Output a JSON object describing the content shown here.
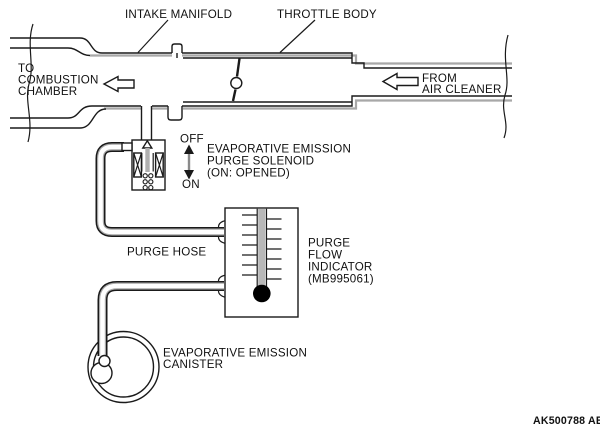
{
  "labels": {
    "intake_manifold": "INTAKE MANIFOLD",
    "throttle_body": "THROTTLE BODY",
    "to_combustion_chamber": [
      "TO",
      "COMBUSTION",
      "CHAMBER"
    ],
    "from_air_cleaner": [
      "FROM",
      "AIR CLEANER"
    ],
    "solenoid_state_off": "OFF",
    "solenoid_state_on": "ON",
    "purge_solenoid": [
      "EVAPORATIVE EMISSION",
      "PURGE SOLENOID",
      "(ON: OPENED)"
    ],
    "purge_hose": "PURGE HOSE",
    "purge_flow_indicator": [
      "PURGE",
      "FLOW",
      "INDICATOR",
      "(MB995061)"
    ],
    "evaporative_emission_canister": [
      "EVAPORATIVE EMISSION",
      "CANISTER"
    ],
    "figure_code": "AK500788 AB"
  },
  "colors": {
    "line": "#1a1a1a",
    "shade": "#a8a8a8",
    "solenoid_plunger": "#b0b0b0",
    "indicator_tube": "#b8b8b8",
    "indicator_float": "#000000"
  }
}
